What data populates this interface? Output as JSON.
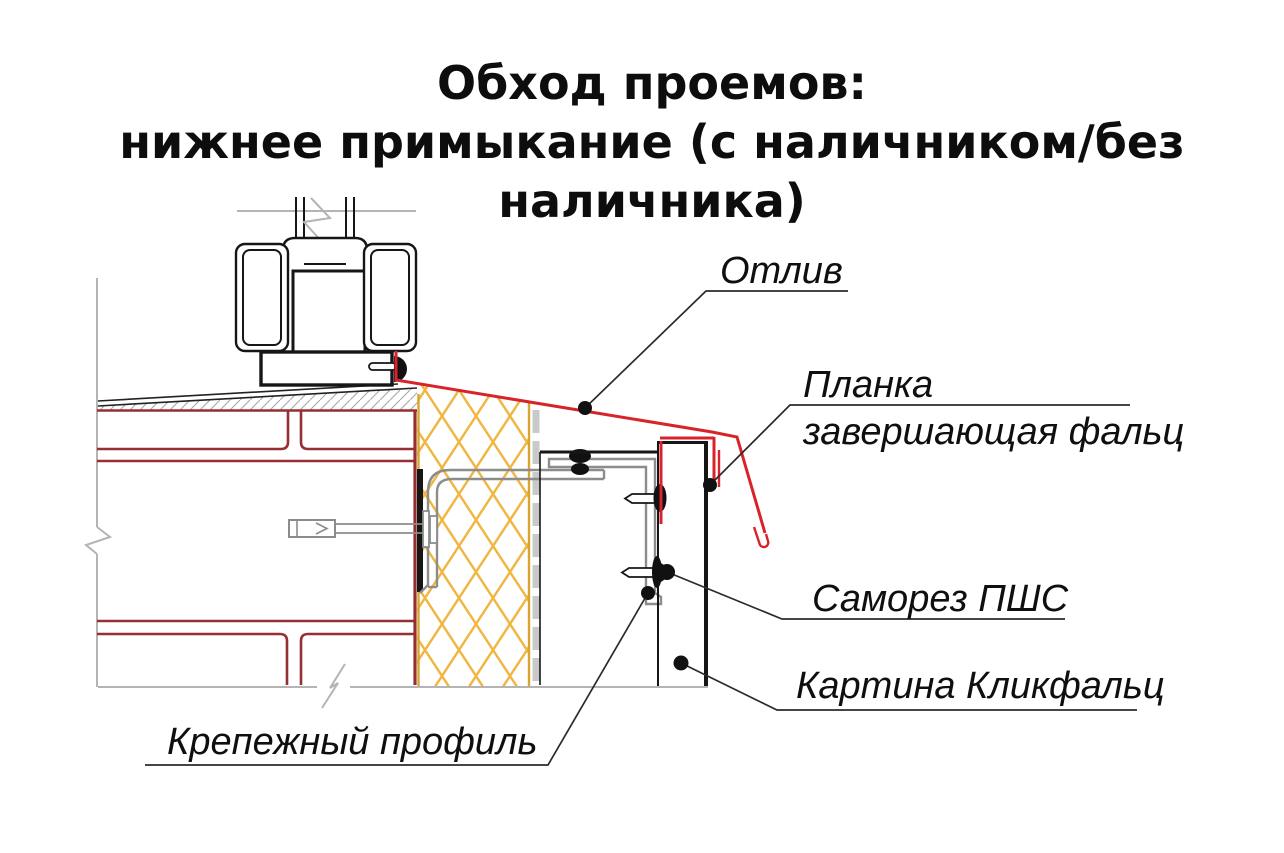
{
  "title": {
    "line1": "Обход проемов:",
    "line2": "нижнее примыкание (с наличником/без наличника)"
  },
  "labels": {
    "otliv": "Отлив",
    "planka_line1": "Планка",
    "planka_line2": "завершающая фальц",
    "samorez": "Саморез ПШС",
    "kartina": "Картина Кликфальц",
    "krepezhny": "Крепежный профиль"
  },
  "colors": {
    "flashing_red": "#d8232b",
    "brick_maroon": "#962f33",
    "insulation_yellow": "#f0b640",
    "insulation_edge": "#d8a62e",
    "metal_gray": "#8c8c8c",
    "construction_gray": "#b4b4b4",
    "line_black": "#161616"
  }
}
